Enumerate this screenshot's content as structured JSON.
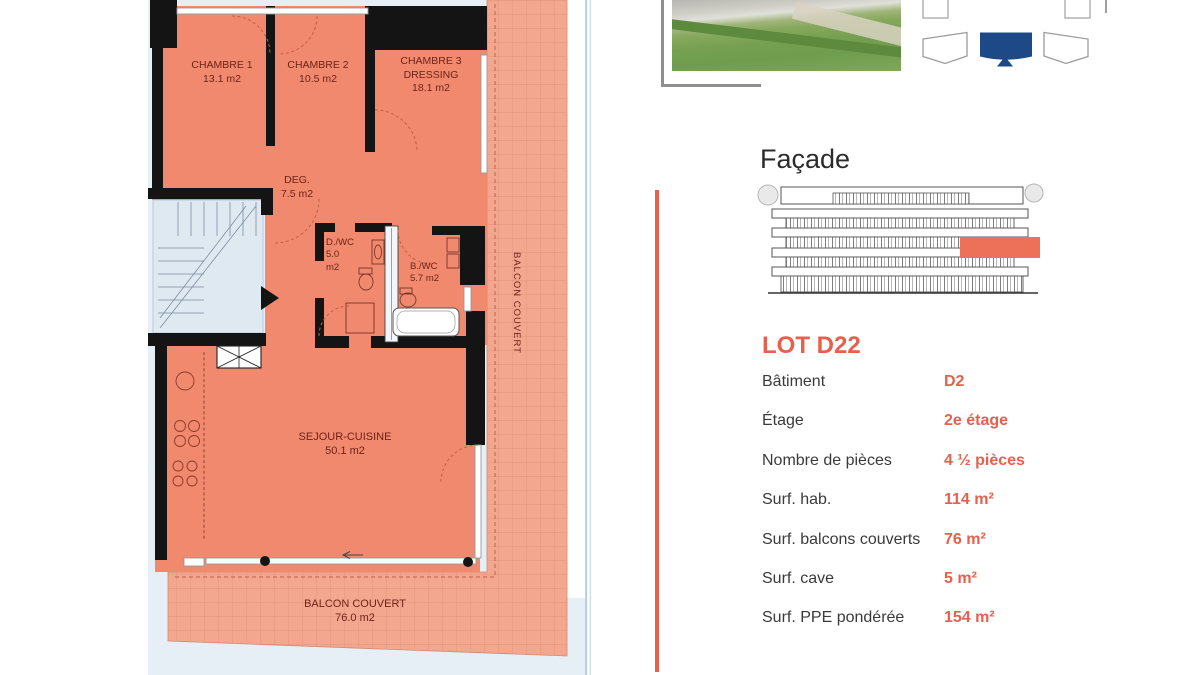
{
  "floor_plan": {
    "chambre1_label": "CHAMBRE 1",
    "chambre1_area": "13.1 m2",
    "chambre2_label": "CHAMBRE 2",
    "chambre2_area": "10.5 m2",
    "chambre3_label": "CHAMBRE 3",
    "chambre3_sub": "DRESSING",
    "chambre3_area": "18.1 m2",
    "deg_label": "DEG.",
    "deg_area": "7.5 m2",
    "dwc_label": "D./WC",
    "dwc_area": "5.0",
    "dwc_unit": "m2",
    "bwc_label": "B./WC",
    "bwc_area": "5.7 m2",
    "sejour_label": "SEJOUR-CUISINE",
    "sejour_area": "50.1 m2",
    "balcon_side_label": "BALCON COUVERT",
    "balcon_bottom_label": "BALCON COUVERT",
    "balcon_bottom_area": "76.0 m2"
  },
  "facade": {
    "title": "Façade"
  },
  "lot": {
    "title": "LOT D22",
    "rows": [
      {
        "label": "Bâtiment",
        "value": "D2"
      },
      {
        "label": "Étage",
        "value": "2e étage"
      },
      {
        "label": "Nombre de pièces",
        "value": "4 ½ pièces"
      },
      {
        "label": "Surf. hab.",
        "value": "114 m²"
      },
      {
        "label": "Surf. balcons couverts",
        "value": "76 m²"
      },
      {
        "label": "Surf. cave",
        "value": "5 m²"
      },
      {
        "label": "Surf. PPE pondérée",
        "value": "154 m²"
      }
    ]
  },
  "colors": {
    "accent": "#E8604D",
    "facade_highlight": "#ED7158",
    "apartment_fill": "#F0896D",
    "balcony_fill": "#F4A78F",
    "site_background": "#E6EEF6",
    "selected_building": "#1D4A87",
    "wall": "#141414"
  }
}
